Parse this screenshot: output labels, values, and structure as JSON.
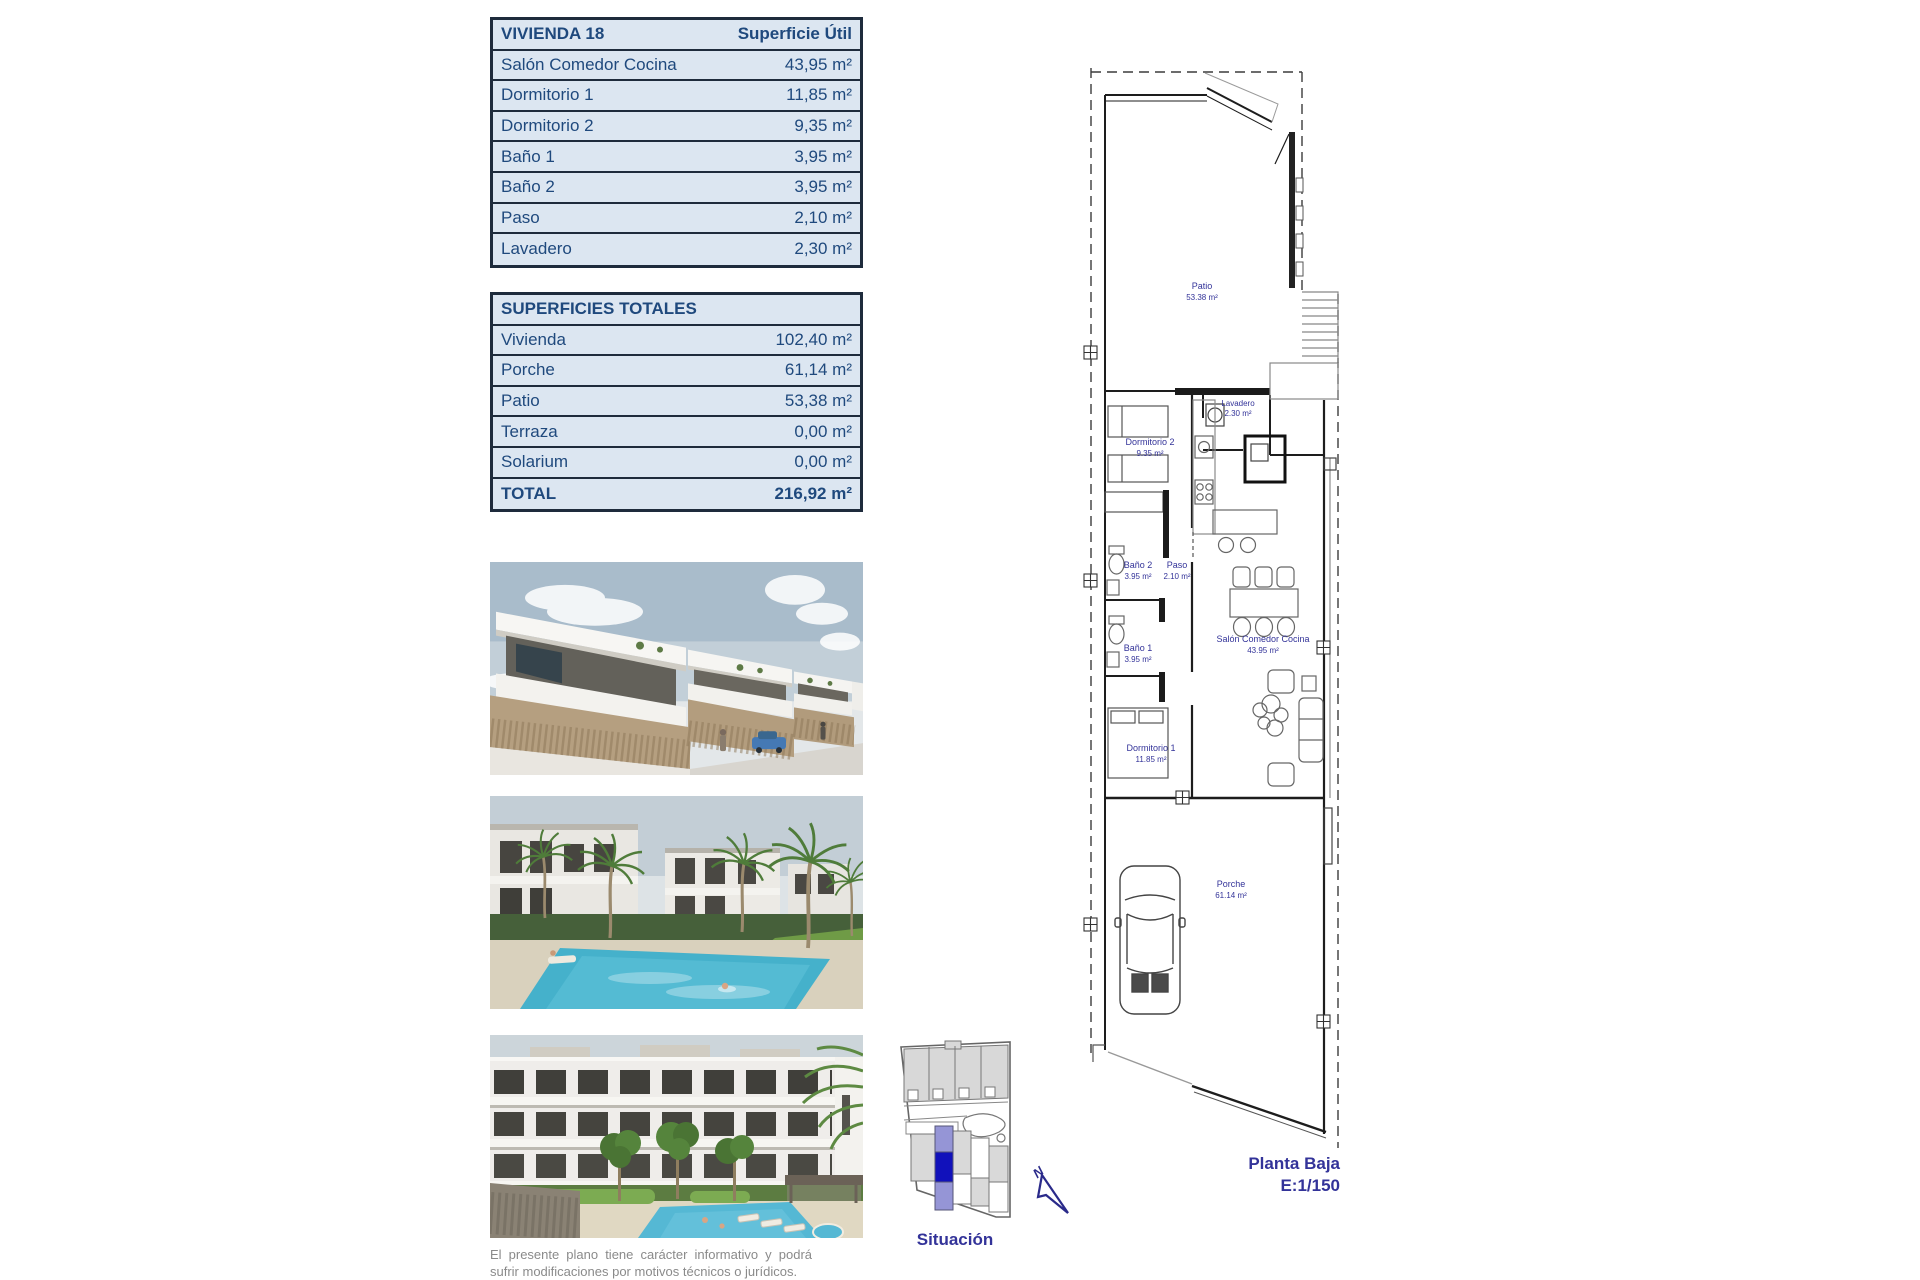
{
  "page": {
    "disclaimer": "El presente plano tiene carácter informativo y podrá sufrir modificaciones por motivos técnicos o jurídicos."
  },
  "vivienda_table": {
    "title": "VIVIENDA 18",
    "header_value": "Superficie Útil",
    "rows": [
      {
        "label": "Salón Comedor Cocina",
        "value": "43,95 m²"
      },
      {
        "label": "Dormitorio 1",
        "value": "11,85 m²"
      },
      {
        "label": "Dormitorio 2",
        "value": "9,35 m²"
      },
      {
        "label": "Baño 1",
        "value": "3,95 m²"
      },
      {
        "label": "Baño 2",
        "value": "3,95 m²"
      },
      {
        "label": "Paso",
        "value": "2,10 m²"
      },
      {
        "label": "Lavadero",
        "value": "2,30 m²"
      }
    ]
  },
  "totales_table": {
    "title": "SUPERFICIES TOTALES",
    "rows": [
      {
        "label": "Vivienda",
        "value": "102,40 m²"
      },
      {
        "label": "Porche",
        "value": "61,14 m²"
      },
      {
        "label": "Patio",
        "value": "53,38 m²"
      },
      {
        "label": "Terraza",
        "value": "0,00 m²"
      },
      {
        "label": "Solarium",
        "value": "0,00 m²"
      }
    ],
    "total": {
      "label": "TOTAL",
      "value": "216,92 m²"
    }
  },
  "floor_plan": {
    "rooms": [
      {
        "name": "Patio",
        "area": "53.38 m²"
      },
      {
        "name": "Lavadero",
        "area": "2.30 m²"
      },
      {
        "name": "Dormitorio 2",
        "area": "9.35 m²"
      },
      {
        "name": "Baño 2",
        "area": "3.95 m²"
      },
      {
        "name": "Paso",
        "area": "2.10 m²"
      },
      {
        "name": "Baño 1",
        "area": "3.95 m²"
      },
      {
        "name": "Salón Comedor Cocina",
        "area": "43.95 m²"
      },
      {
        "name": "Dormitorio 1",
        "area": "11.85 m²"
      },
      {
        "name": "Porche",
        "area": "61.14 m²"
      }
    ],
    "caption_title": "Planta Baja",
    "caption_scale": "E:1/150"
  },
  "situacion": {
    "label": "Situación",
    "north": "N"
  },
  "colors": {
    "table_bg": "#dce6f1",
    "table_border": "#1e2b3c",
    "table_text": "#1f497d",
    "plan_label": "#333399"
  }
}
